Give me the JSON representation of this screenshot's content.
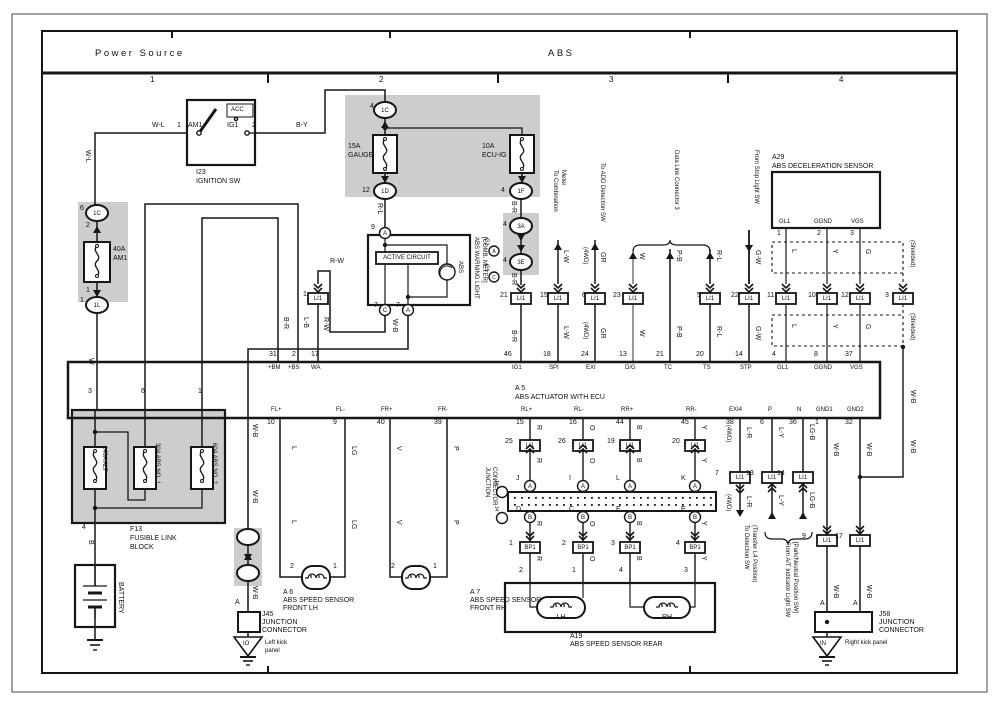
{
  "header": {
    "left": "Power Source",
    "abs": "ABS",
    "c1": "1",
    "c2": "2",
    "c3": "3",
    "c4": "4"
  },
  "n": {
    "1": "1",
    "2": "2",
    "3": "3",
    "4": "4",
    "5": "5",
    "6": "6",
    "7": "7",
    "8": "8",
    "9": "9",
    "10": "10",
    "11": "11",
    "12": "12",
    "13": "13",
    "14": "14",
    "15": "15",
    "16": "16",
    "17": "17",
    "18": "18",
    "19": "19",
    "20": "20",
    "21": "21",
    "22": "22",
    "23": "23",
    "24": "24",
    "25": "25",
    "26": "26",
    "31": "31",
    "32": "32",
    "36": "36",
    "37": "37",
    "38": "38",
    "39": "39",
    "40": "40",
    "44": "44",
    "45": "45",
    "46": "46"
  },
  "lt": {
    "a": "A",
    "b": "B",
    "c": "C",
    "d": "D",
    "e": "E",
    "f": "F",
    "i": "I",
    "j": "J",
    "k": "K",
    "l": "L"
  },
  "wire": {
    "wl": "W-L",
    "by": "B-Y",
    "w": "W",
    "b": "B",
    "rl": "R-L",
    "br": "B-R",
    "lb": "L-B",
    "lw": "L-W",
    "rw": "R-W",
    "wb": "W-B",
    "gr": "GR",
    "pb": "P-B",
    "gw": "G-W",
    "l": "L",
    "y": "Y",
    "g": "G",
    "lg": "LG",
    "v": "V",
    "p": "P",
    "r": "R",
    "o": "O",
    "bk": "B",
    "lr": "L-R",
    "ly": "L-Y",
    "lgb": "LG-B",
    "awd": "(4WD)",
    "shielded": "(Shielded)"
  },
  "term": {
    "am1": "AM1",
    "ig1": "IG1",
    "acc": "ACC",
    "bm": "+BM",
    "bs": "+BS",
    "wa": "WA",
    "spi": "SPI",
    "exi": "EXI",
    "dg": "D/G",
    "tc": "TC",
    "ts": "TS",
    "stp": "STP",
    "gl1": "GL1",
    "ggnd": "GGND",
    "vgs": "VGS",
    "flp": "FL+",
    "flm": "FL-",
    "frp": "FR+",
    "frm": "FR-",
    "rlp": "RL+",
    "rlm": "RL-",
    "rrp": "RR+",
    "rrm": "RR-",
    "exi4": "EXI4",
    "p": "P",
    "n": "N",
    "gnd1": "GND1",
    "gnd2": "GND2"
  },
  "conn": {
    "c1c": "1C",
    "c1d": "1D",
    "c1f": "1F",
    "c1l": "1L",
    "c3a": "3A",
    "c3e": "3E",
    "li1": "LI1",
    "bp1": "BP1",
    "j4": "J4",
    "c1": "C1"
  },
  "comp": {
    "ignition": {
      "id": "I23",
      "name": "IGNITION SW"
    },
    "fuse_am1": {
      "amp": "40A",
      "name": "AM1"
    },
    "fuse_gauge": {
      "amp": "15A",
      "name": "GAUGE"
    },
    "fuse_ecuig": {
      "amp": "10A",
      "name": "ECU-IG"
    },
    "f13": {
      "id": "F13",
      "l1": "FUSIBLE LINK",
      "l2": "BLOCK",
      "f1": "140A ALT",
      "f2": "30A ABS NO. 1",
      "f3": "60A ABS NO. 2"
    },
    "battery": "BATTERY",
    "meter": {
      "active": "ACTIVE CIRCUIT",
      "bulb": "ABS",
      "l1": "ABS WARNING LIGHT",
      "l2": "[COMB. METER]"
    },
    "a29": {
      "id": "A29",
      "name": "ABS DECELERATION SENSOR"
    },
    "a5": {
      "id": "A 5",
      "name": "ABS ACTUATOR WITH ECU"
    },
    "a6": {
      "id": "A 6",
      "l1": "ABS SPEED SENSOR",
      "l2": "FRONT LH"
    },
    "a7": {
      "id": "A 7",
      "l1": "ABS SPEED SENSOR",
      "l2": "FRONT RH"
    },
    "a19": {
      "id": "A19",
      "name": "ABS SPEED SENSOR REAR",
      "lh": "LH",
      "rh": "RH"
    },
    "j45": "J45",
    "j58": "J58",
    "junction": "JUNCTION",
    "connector": "CONNECTOR"
  },
  "ref": {
    "to_comb1": "To Combination",
    "to_comb2": "Meter",
    "to_add": "To ADD Detection SW",
    "dlc3": "Data Link Connector 3",
    "from_stop": "From Stop Light SW",
    "to_det1": "To Detection SW",
    "to_det2": "(Transfer L4 Position)",
    "from_at1": "From A/T Indicator Light SW",
    "from_at2": "[Park/Neutral Position SW]"
  },
  "gnd": {
    "left_code": "IO",
    "left1": "Left kick",
    "left2": "panel",
    "right_code": "IN",
    "right": "Right kick panel"
  },
  "colors": {
    "ink": "#161616",
    "gray_fill": "#cdcdcd",
    "paper": "#ffffff"
  }
}
